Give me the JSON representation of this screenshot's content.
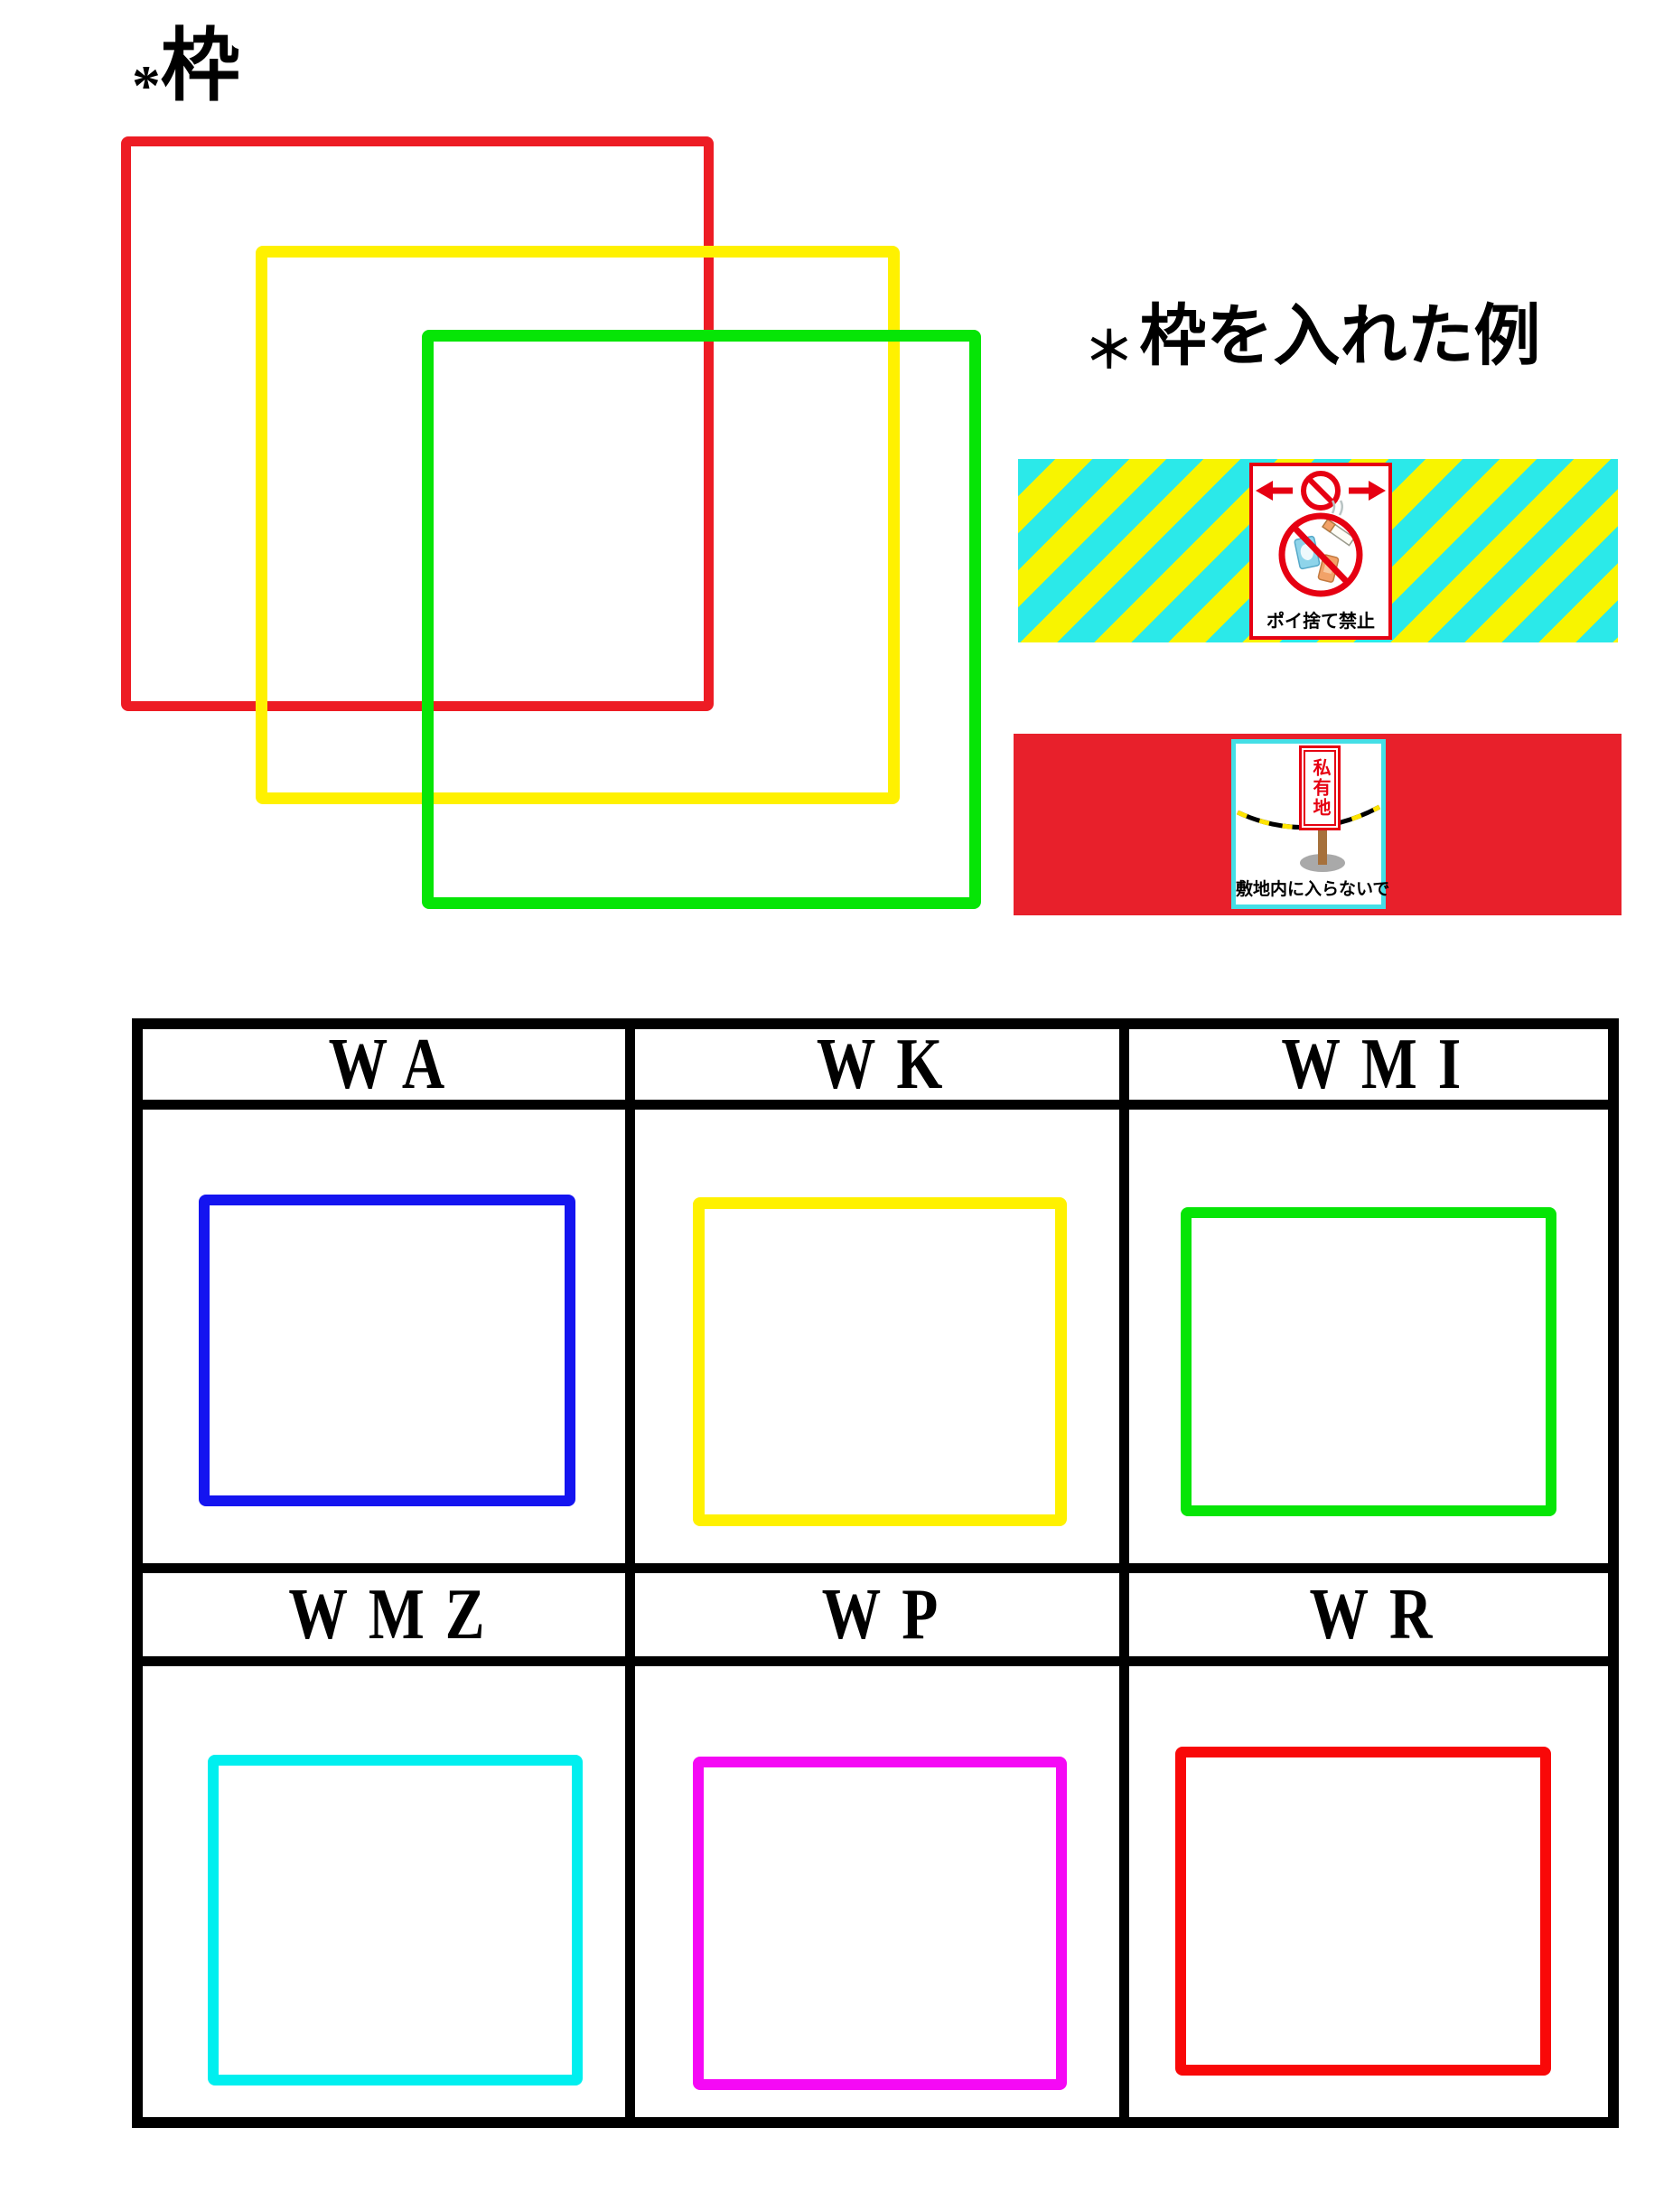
{
  "title": {
    "asterisk": "*",
    "text": "枠"
  },
  "example": {
    "asterisk": "＊",
    "text": "枠を入れた例"
  },
  "colors": {
    "red": "#ED1C24",
    "pure_red": "#F90808",
    "yellow": "#FFF100",
    "green": "#06E506",
    "blue": "#1414F0",
    "cyan": "#00EFEF",
    "magenta": "#F509F5",
    "stripe_yellow": "#F8F400",
    "stripe_cyan": "#2BE9E9",
    "banner_red": "#E8202B",
    "sign_red": "#E60012",
    "sign_cyan": "#44DFE6",
    "post_brown": "#A6713C",
    "base_gray": "#A9A9A9",
    "can_blue": "#8ED4EA",
    "can_orange": "#F2A268",
    "rope_yellow": "#FFE400"
  },
  "banners": {
    "litter": {
      "caption": "ポイ捨て禁止"
    },
    "private": {
      "plate_text": "私有地",
      "caption": "敷地内に入らないで"
    }
  },
  "table": {
    "headers": [
      "WA",
      "WK",
      "WMI",
      "WMZ",
      "WP",
      "WR"
    ]
  }
}
